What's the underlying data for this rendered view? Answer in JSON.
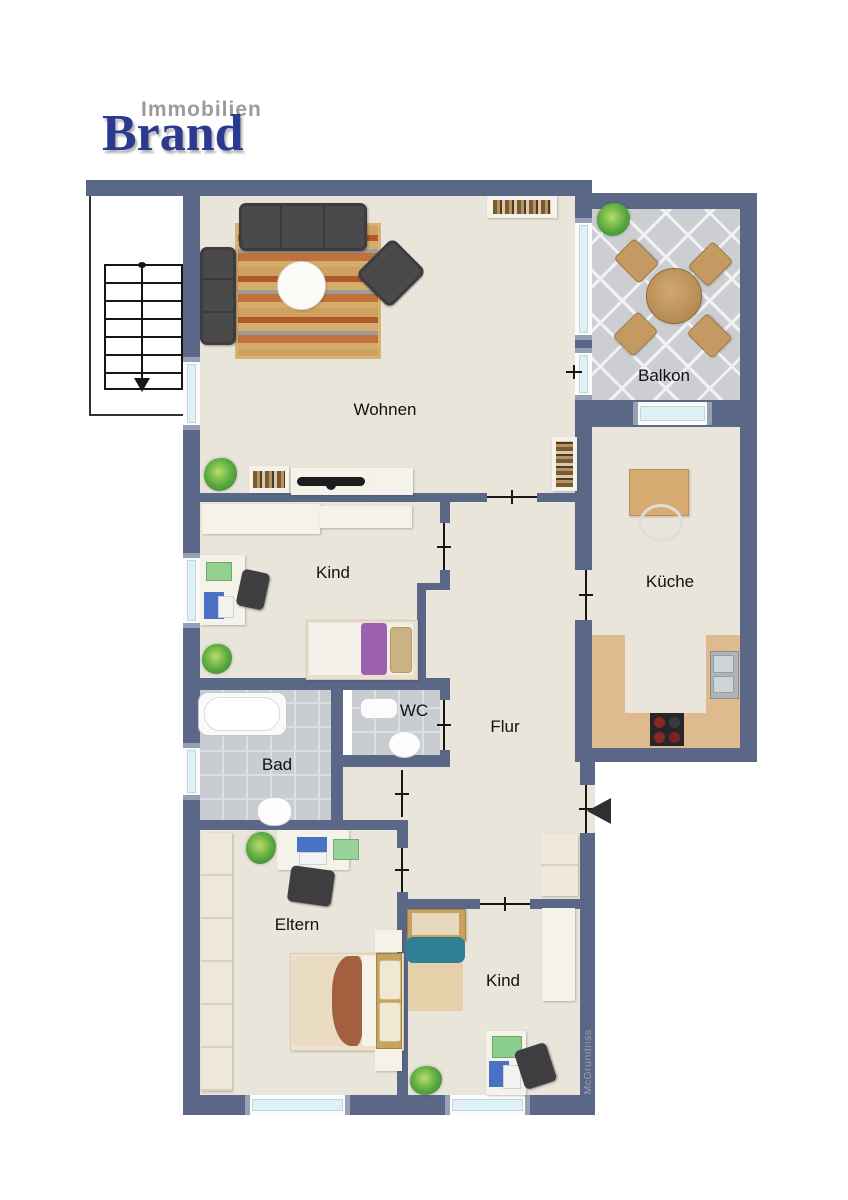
{
  "logo": {
    "line1": "Immobilien",
    "line2": "Brand"
  },
  "watermark": "McGrundriss",
  "rooms": {
    "wohnen": {
      "label": "Wohnen"
    },
    "balkon": {
      "label": "Balkon"
    },
    "kind1": {
      "label": "Kind"
    },
    "kueche": {
      "label": "Küche"
    },
    "wc": {
      "label": "WC"
    },
    "flur": {
      "label": "Flur"
    },
    "bad": {
      "label": "Bad"
    },
    "eltern": {
      "label": "Eltern"
    },
    "kind2": {
      "label": "Kind"
    }
  },
  "colors": {
    "wall": "#5a6787",
    "floor": "#eae5da",
    "glass": "#def2f6",
    "tileBath": "#c9ccd0",
    "tileBalcony": "#ccced2",
    "counter": "#dfba8e",
    "sofa": "#4a4a4d",
    "wood": "#c9a06b",
    "logoBlue": "#2b3a90",
    "logoGray": "#9b9b9b"
  }
}
